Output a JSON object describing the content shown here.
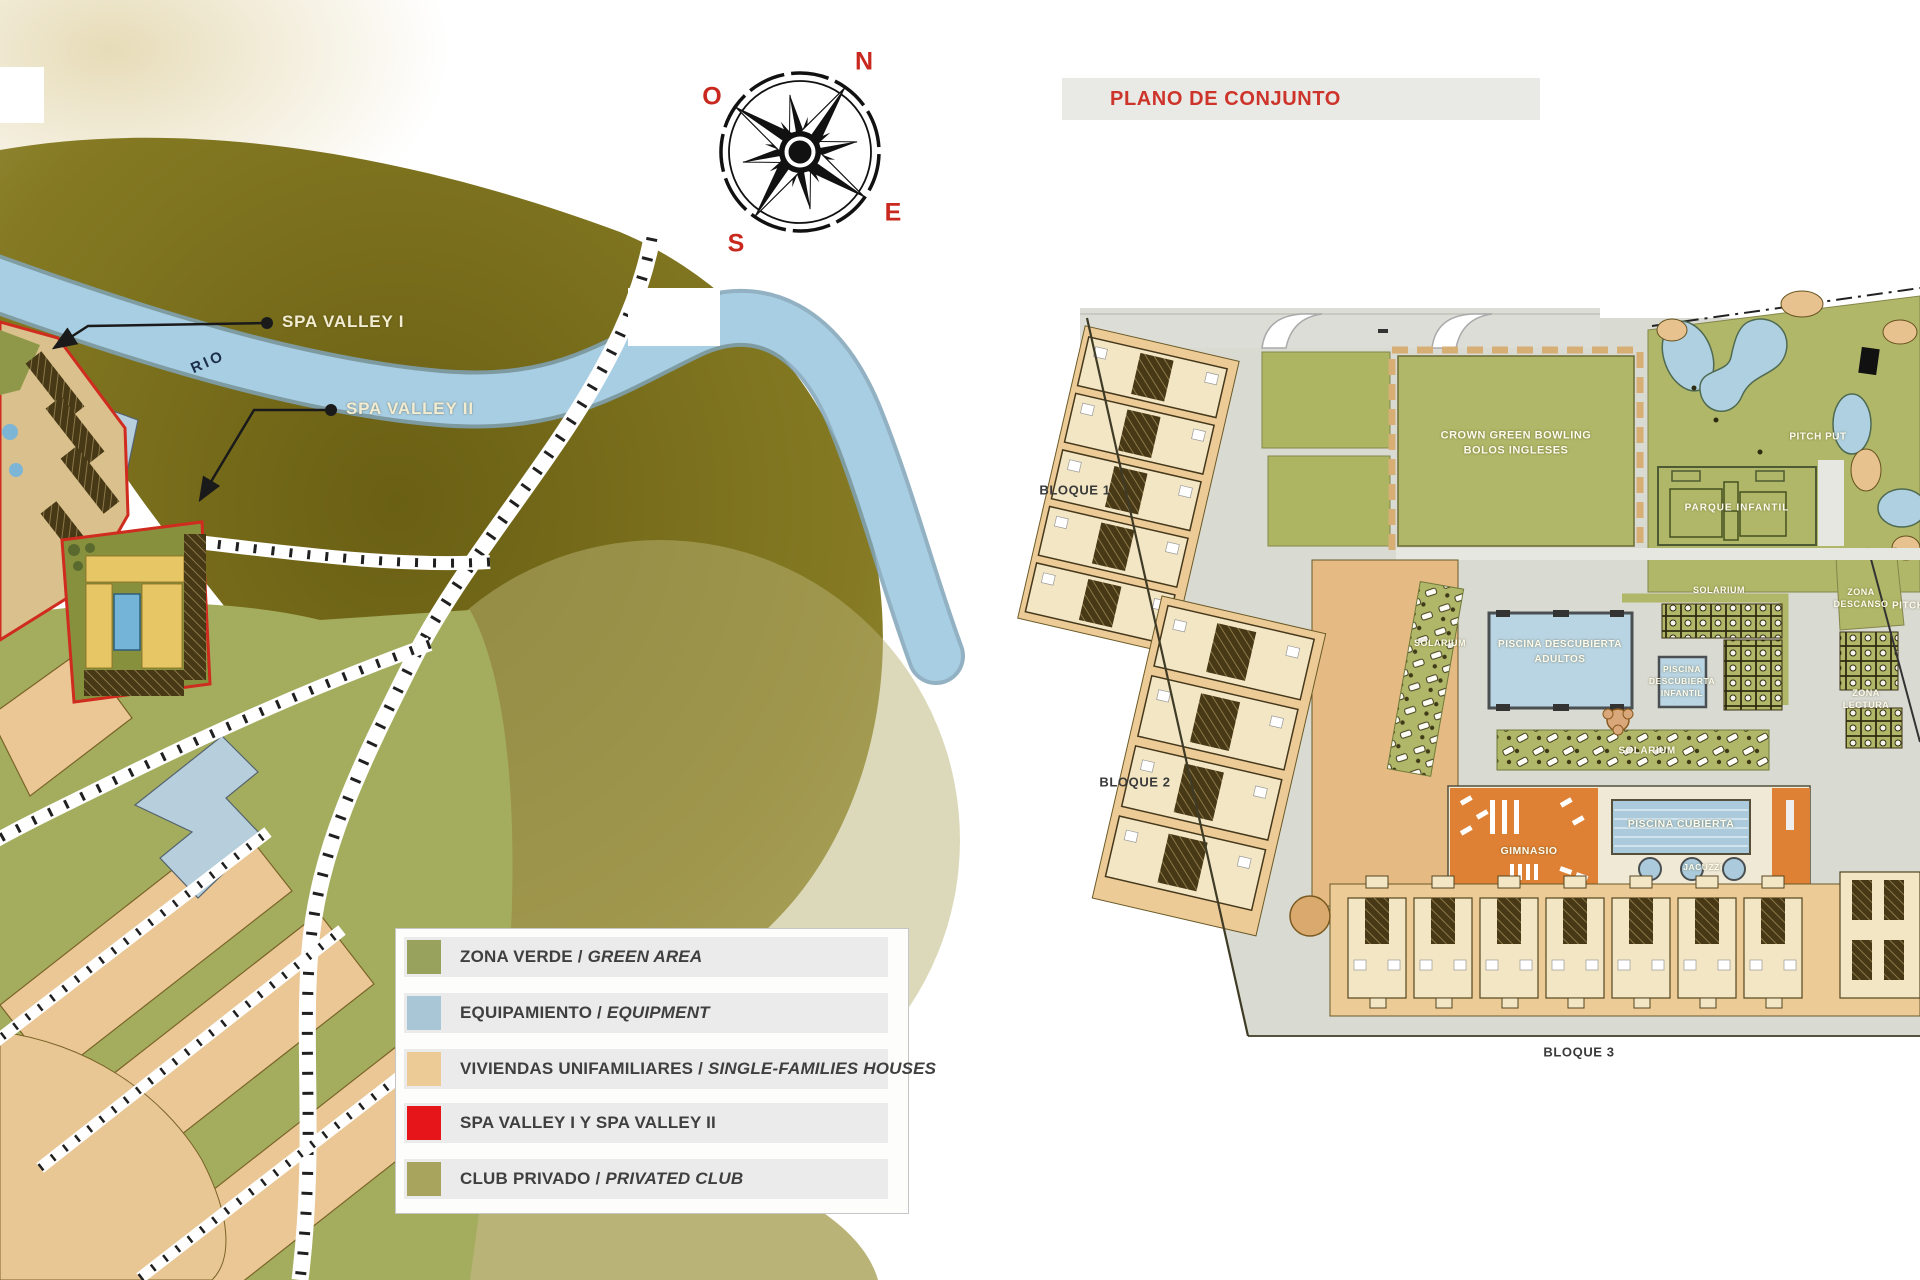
{
  "left_map": {
    "compass": {
      "n": "N",
      "e": "E",
      "s": "S",
      "o": "O"
    },
    "river_label": "RIO",
    "callout_1": "SPA VALLEY I",
    "callout_2": "SPA VALLEY II",
    "legend": {
      "items": [
        {
          "label": "ZONA VERDE /",
          "sublabel": "GREEN AREA",
          "color": "#99a25c"
        },
        {
          "label": "EQUIPAMIENTO /",
          "sublabel": "EQUIPMENT",
          "color": "#a9c6d7"
        },
        {
          "label": "VIVIENDAS UNIFAMILIARES /",
          "sublabel": "SINGLE-FAMILIES HOUSES",
          "color": "#edcb97"
        },
        {
          "label": "SPA VALLEY I Y SPA VALLEY II",
          "sublabel": "",
          "color": "#e6151a"
        },
        {
          "label": "CLUB PRIVADO /",
          "sublabel": "PRIVATED CLUB",
          "color": "#a8a35d"
        }
      ]
    }
  },
  "site_plan": {
    "title": "PLANO DE CONJUNTO",
    "title_color": "#cd342a",
    "blocks": [
      {
        "label": "BLOQUE 1"
      },
      {
        "label": "BLOQUE 2"
      },
      {
        "label": "BLOQUE 3"
      }
    ],
    "labels": {
      "bowling_1": "CROWN GREEN BOWLING",
      "bowling_2": "BOLOS INGLESES",
      "pitch_put": "PITCH PUT",
      "parque_infantil": "PARQUE INFANTIL",
      "pool_adults_1": "PISCINA DESCUBIERTA",
      "pool_adults_2": "ADULTOS",
      "pool_infant_1": "PISCINA",
      "pool_infant_2": "DESCUBIERTA",
      "pool_infant_3": "INFANTIL",
      "solarium": "SOLARIUM",
      "zona_descanso_1": "ZONA",
      "zona_descanso_2": "DESCANSO",
      "zona_lectura_1": "ZONA",
      "zona_lectura_2": "LECTURA",
      "gimnasio": "GIMNASIO",
      "piscina_cubierta": "PISCINA CUBIERTA",
      "jacuzzi": "JACUZZI"
    }
  }
}
